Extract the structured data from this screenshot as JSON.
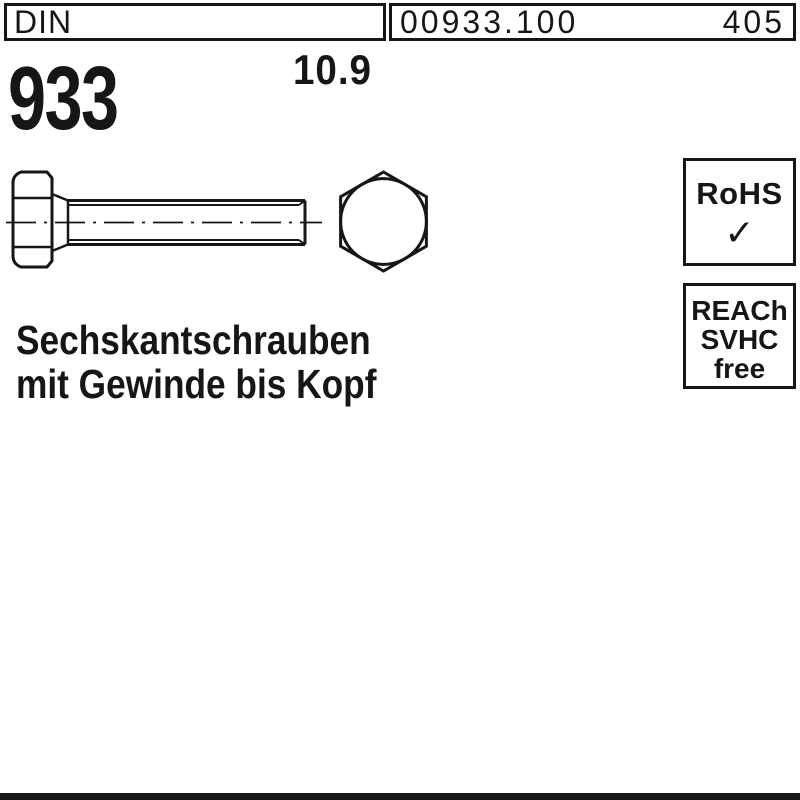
{
  "colors": {
    "ink": "#161616",
    "background": "#ffffff"
  },
  "header": {
    "standard": "DIN",
    "article_number": "00933.100",
    "page_number": "405"
  },
  "product": {
    "din_number": "933",
    "strength_class": "10.9",
    "name_line1": "Sechskantschrauben",
    "name_line2": "mit Gewinde bis Kopf"
  },
  "badges": {
    "rohs": {
      "label": "RoHS",
      "check": "✓"
    },
    "reach": {
      "line1": "REACh",
      "line2": "SVHC",
      "line3": "free"
    }
  },
  "drawing": {
    "description": "Hex head bolt DIN 933, side view with full thread and hex front view",
    "side_view": "bolt-side-view",
    "front_view": "hex-head-front-view"
  }
}
